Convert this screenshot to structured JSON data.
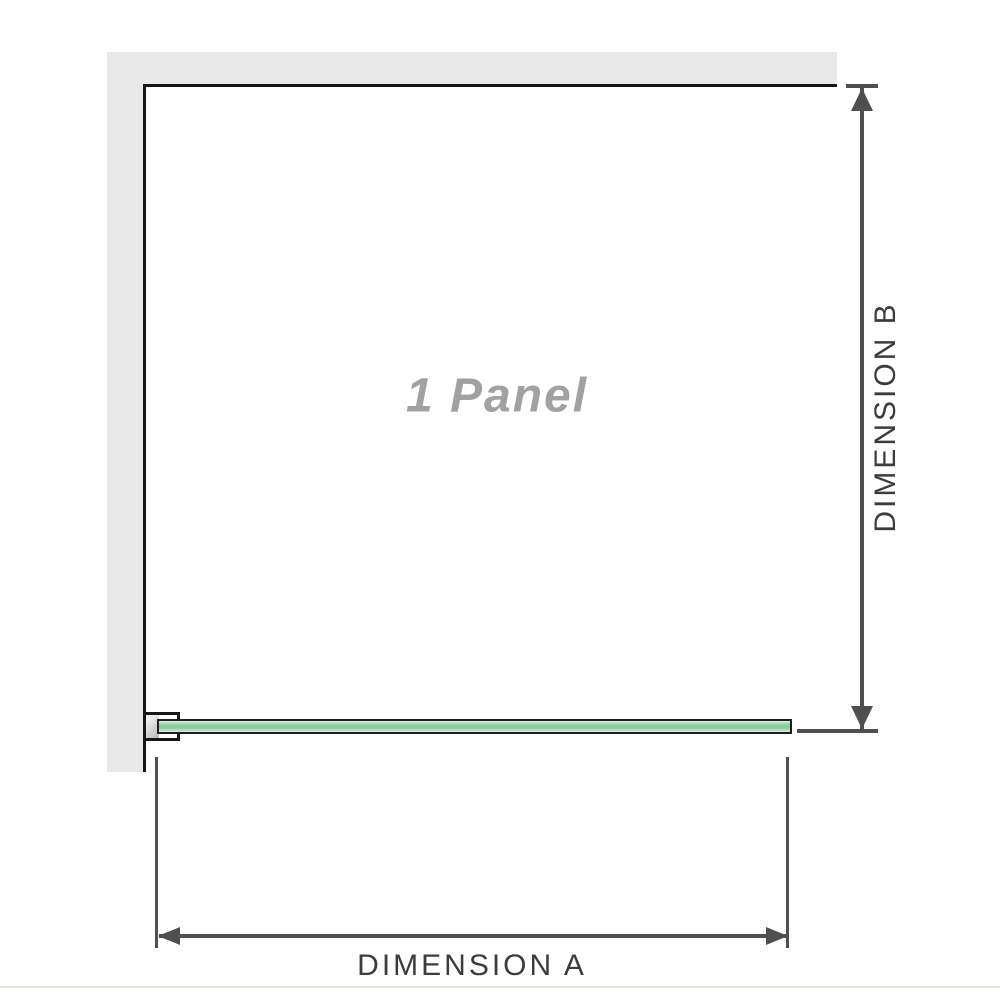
{
  "diagram": {
    "panel_label": "1 Panel",
    "dimension_a": {
      "label": "DIMENSION A"
    },
    "dimension_b": {
      "label": "DIMENSION B"
    }
  },
  "icons": {
    "dimension_b_arrows": [
      "arrow-up",
      "arrow-down"
    ],
    "dimension_a_arrows": [
      "arrow-left",
      "arrow-right"
    ]
  },
  "colors": {
    "wall": "#e9e9e9",
    "outline": "#161616",
    "dimension": "#4f4f4f",
    "dim-text": "#3c3c3c",
    "label-gray": "#a1a1a1",
    "glass-border": "#1f1f1f",
    "glass-light": "#ddf1e6",
    "glass-mid": "#9ad3ab",
    "glass-dark": "#87c79b",
    "bracket-fill": "#ffffff",
    "bracket-shade": "#b9b9b9",
    "divider": "#e4e1db"
  }
}
